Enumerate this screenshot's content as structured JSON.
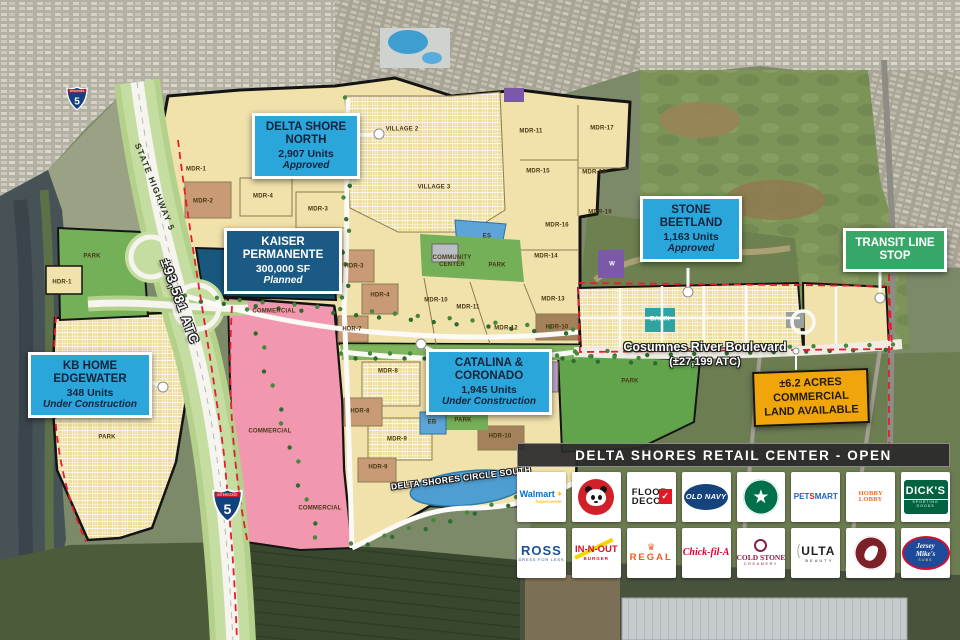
{
  "colors": {
    "callout_blue": "#2ba6db",
    "callout_navy": "#1a5a84",
    "callout_green": "#37a768",
    "callout_gold": "#f0a50a",
    "plan_yellow": "#f1e1ab",
    "park_green": "#74b058",
    "commercial_pink": "#f297b0",
    "kaiser_parcel_blue": "#19587e",
    "water_blue": "#4f9ed1"
  },
  "map": {
    "road_labels": {
      "state_highway": "STATE HIGHWAY 5",
      "highway_traffic_count": "±93,581 ATC",
      "cosumnes_name": "Cosumnes River Boulevard",
      "cosumnes_traffic_count": "(±27,199 ATC)",
      "delta_shores_circle_south": "DELTA SHORES CIRCLE SOUTH"
    },
    "interstate_shield": {
      "top_label": "INTERSTATE",
      "route_number": "5"
    },
    "plan_labels": [
      {
        "t": "PARK",
        "x": 92,
        "y": 257
      },
      {
        "t": "HDR-1",
        "x": 62,
        "y": 283
      },
      {
        "t": "MDR-1",
        "x": 196,
        "y": 170
      },
      {
        "t": "MDR-2",
        "x": 203,
        "y": 202
      },
      {
        "t": "MDR-4",
        "x": 263,
        "y": 197
      },
      {
        "t": "MDR-3",
        "x": 318,
        "y": 210
      },
      {
        "t": "VILLAGE 2",
        "x": 402,
        "y": 130
      },
      {
        "t": "VILLAGE 3",
        "x": 434,
        "y": 188
      },
      {
        "t": "MDR-11",
        "x": 531,
        "y": 132
      },
      {
        "t": "MDR-17",
        "x": 602,
        "y": 129
      },
      {
        "t": "MDR-15",
        "x": 538,
        "y": 172
      },
      {
        "t": "MDR-18",
        "x": 594,
        "y": 173
      },
      {
        "t": "MDR-19",
        "x": 600,
        "y": 213
      },
      {
        "t": "MDR-16",
        "x": 557,
        "y": 226
      },
      {
        "t": "ES",
        "x": 487,
        "y": 237
      },
      {
        "t": "COMMUNITY CENTER",
        "x": 452,
        "y": 262,
        "w": 46
      },
      {
        "t": "PARK",
        "x": 497,
        "y": 266
      },
      {
        "t": "MDR-14",
        "x": 546,
        "y": 257
      },
      {
        "t": "W",
        "x": 612,
        "y": 265,
        "c": "#ffffff"
      },
      {
        "t": "HDR-3",
        "x": 354,
        "y": 267
      },
      {
        "t": "HDR-4",
        "x": 380,
        "y": 296
      },
      {
        "t": "MDR-10",
        "x": 436,
        "y": 301
      },
      {
        "t": "MDR-11",
        "x": 468,
        "y": 308
      },
      {
        "t": "MDR-12",
        "x": 506,
        "y": 329
      },
      {
        "t": "MDR-13",
        "x": 553,
        "y": 300
      },
      {
        "t": "HDR-10",
        "x": 557,
        "y": 328
      },
      {
        "t": "COMMERCIAL",
        "x": 274,
        "y": 312
      },
      {
        "t": "COMMERCIAL",
        "x": 270,
        "y": 432
      },
      {
        "t": "COMMERCIAL",
        "x": 320,
        "y": 509
      },
      {
        "t": "HDR-7",
        "x": 352,
        "y": 330
      },
      {
        "t": "MDR-8",
        "x": 388,
        "y": 372
      },
      {
        "t": "HDR-8",
        "x": 360,
        "y": 412
      },
      {
        "t": "MDR-9",
        "x": 397,
        "y": 440
      },
      {
        "t": "HDR-9",
        "x": 378,
        "y": 468
      },
      {
        "t": "EB",
        "x": 432,
        "y": 423
      },
      {
        "t": "PARK",
        "x": 463,
        "y": 421
      },
      {
        "t": "HDR-10",
        "x": 500,
        "y": 437
      },
      {
        "t": "MU",
        "x": 540,
        "y": 378
      },
      {
        "t": "PARK",
        "x": 630,
        "y": 382
      },
      {
        "t": "PARK",
        "x": 107,
        "y": 438
      },
      {
        "t": "Basin",
        "x": 660,
        "y": 320,
        "c": "#ffffff"
      }
    ]
  },
  "callouts": {
    "delta_shore_north": {
      "title": "DELTA SHORE NORTH",
      "units": "2,907 Units",
      "status": "Approved"
    },
    "kaiser_permanente": {
      "title": "KAISER PERMANENTE",
      "size": "300,000 SF",
      "status": "Planned"
    },
    "stone_beetland": {
      "title": "STONE BEETLAND",
      "units": "1,163 Units",
      "status": "Approved"
    },
    "transit_line_stop": {
      "title": "TRANSIT LINE STOP"
    },
    "kb_home_edgewater": {
      "title": "KB HOME EDGEWATER",
      "units": "348 Units",
      "status": "Under Construction"
    },
    "catalina_coronado": {
      "title": "CATALINA & CORONADO",
      "units": "1,945 Units",
      "status": "Under Construction"
    },
    "commercial_land": {
      "title": "±6.2 ACRES COMMERCIAL LAND AVAILABLE"
    }
  },
  "retail_center": {
    "header": "DELTA SHORES RETAIL CENTER - OPEN",
    "logos": [
      {
        "id": "walmart",
        "style": "walmart",
        "name": "Walmart",
        "sub": "Supercenter",
        "color": "#0071ce",
        "accent": "#ffc220"
      },
      {
        "id": "panda-express",
        "style": "panda",
        "name": "Panda Express",
        "color": "#d02029"
      },
      {
        "id": "floor-and-decor",
        "style": "floordecor",
        "line1": "FLOOR",
        "line2": "DECOR",
        "name": "Floor & Decor",
        "color": "#1a1a1a",
        "accent": "#e01a22"
      },
      {
        "id": "old-navy",
        "style": "oval",
        "name": "OLD NAVY",
        "color": "#ffffff",
        "bg": "#15437c"
      },
      {
        "id": "starbucks",
        "style": "starbucks",
        "name": "Starbucks",
        "color": "#00704a"
      },
      {
        "id": "petsmart",
        "style": "petsmart",
        "p1": "PET",
        "p2": "S",
        "p3": "MART",
        "name": "PetSmart",
        "color": "#1c63b7",
        "accent": "#e11b22"
      },
      {
        "id": "hobby-lobby",
        "style": "text",
        "name": "HOBBY LOBBY",
        "color": "#ee6b24"
      },
      {
        "id": "dicks-sporting-goods",
        "style": "dicks",
        "name": "DICK'S",
        "sub": "SPORTING GOODS",
        "bg": "#00623f",
        "color": "#ffffff"
      },
      {
        "id": "ross",
        "style": "ross",
        "name": "ROSS",
        "sub": "DRESS FOR LESS",
        "color": "#1b4f9c"
      },
      {
        "id": "in-n-out",
        "style": "innout",
        "name": "IN-N-OUT",
        "sub": "BURGER",
        "color": "#d0112b",
        "accent": "#f8d500"
      },
      {
        "id": "regal",
        "style": "regal",
        "name": "REGAL",
        "color": "#f15a22"
      },
      {
        "id": "chick-fil-a",
        "style": "script",
        "name": "Chick-fil-A",
        "color": "#dd0031"
      },
      {
        "id": "cold-stone",
        "style": "coldstone",
        "name": "COLD STONE",
        "sub": "CREAMERY",
        "color": "#8a1e41"
      },
      {
        "id": "ulta",
        "style": "ulta",
        "name": "ULTA",
        "sub": "BEAUTY",
        "color": "#241f21"
      },
      {
        "id": "chipotle",
        "style": "chipotle",
        "name": "Chipotle",
        "color": "#7d2128"
      },
      {
        "id": "jersey-mikes",
        "style": "jersey",
        "line1": "Jersey",
        "line2": "Mike's",
        "sub": "SUBS",
        "name": "Jersey Mike's",
        "bg": "#1d4b9a",
        "accent": "#cf1230",
        "color": "#ffffff"
      }
    ]
  }
}
